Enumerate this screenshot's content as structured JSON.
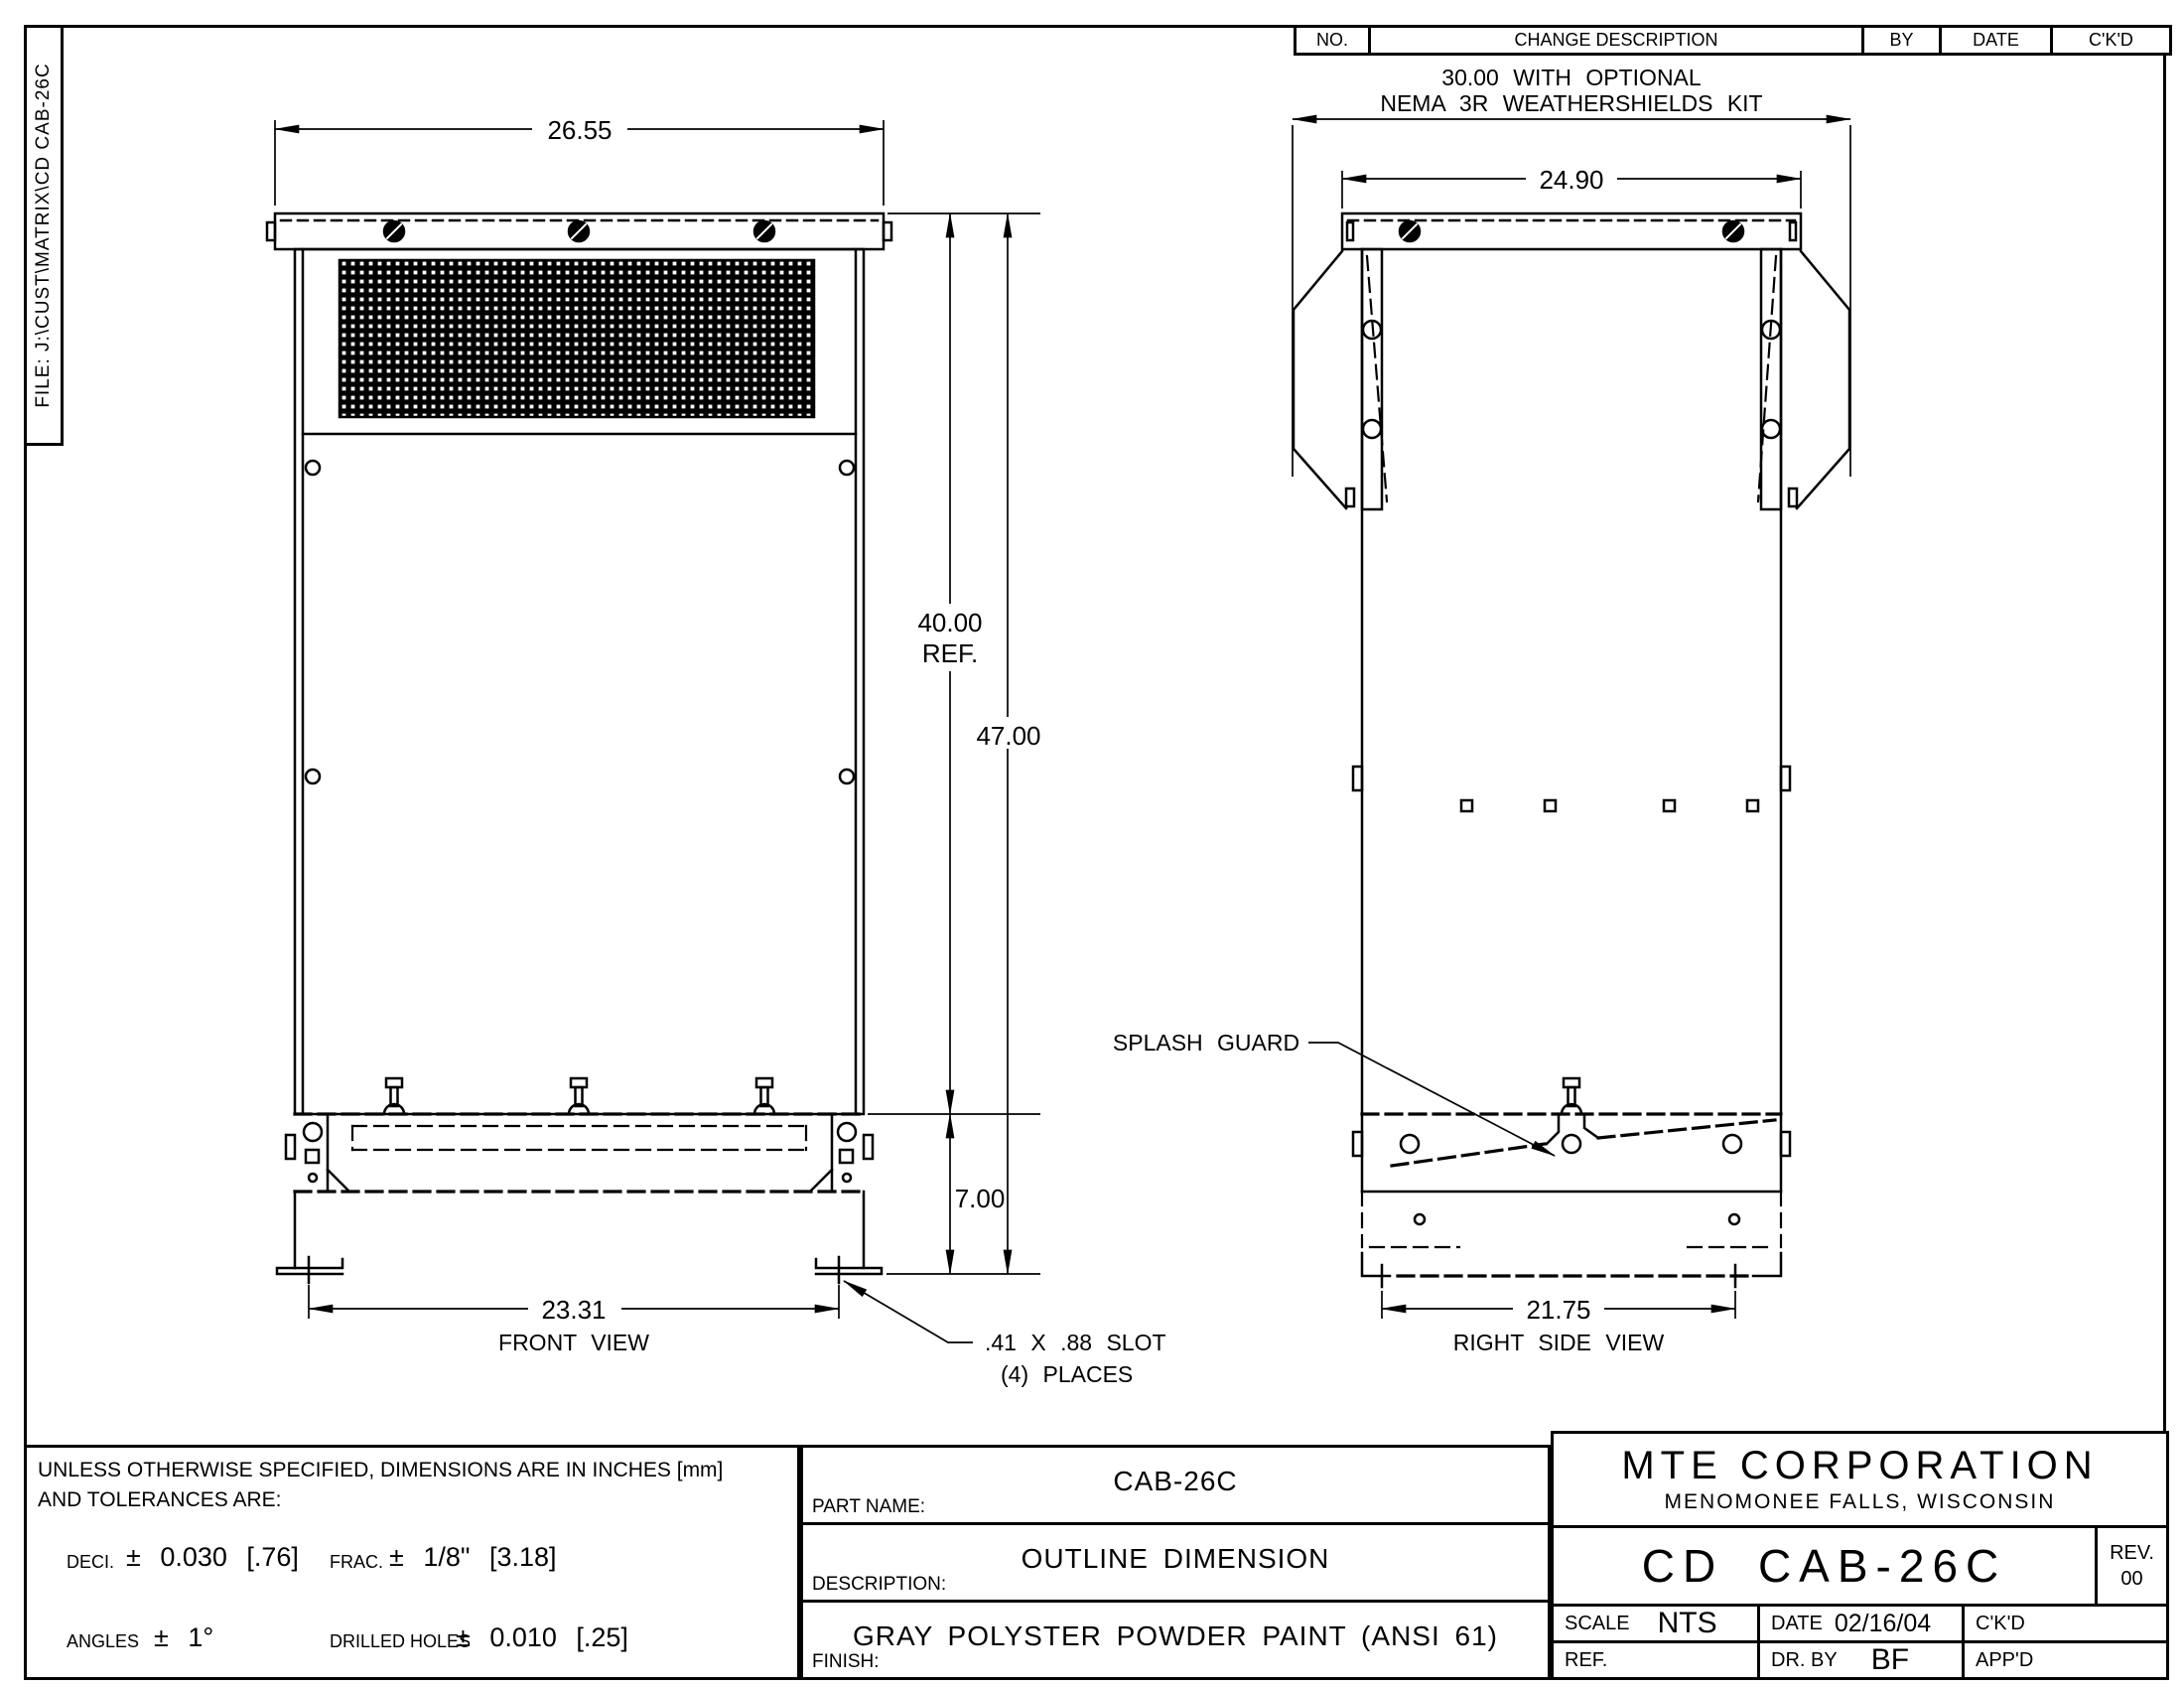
{
  "file_label": "FILE: J:\\CUST\\MATRIX\\CD CAB-26C",
  "revision_table": {
    "headers": [
      "NO.",
      "CHANGE DESCRIPTION",
      "BY",
      "DATE",
      "C'K'D"
    ]
  },
  "front_view": {
    "label": "FRONT VIEW",
    "dim_top_width": "26.55",
    "dim_height_ref_line1": "40.00",
    "dim_height_ref_line2": "REF.",
    "dim_height_overall": "47.00",
    "dim_base_height": "7.00",
    "dim_base_width": "23.31",
    "slot_note_line1": ".41 X .88 SLOT",
    "slot_note_line2": "(4) PLACES"
  },
  "side_view": {
    "label": "RIGHT SIDE VIEW",
    "weathershield_note_line1": "30.00 WITH OPTIONAL",
    "weathershield_note_line2": "NEMA 3R WEATHERSHIELDS KIT",
    "dim_top_width": "24.90",
    "dim_base_width": "21.75",
    "splash_guard_label": "SPLASH GUARD"
  },
  "tolerance_block": {
    "line1": "UNLESS OTHERWISE SPECIFIED, DIMENSIONS ARE IN INCHES [mm]",
    "line2": "AND TOLERANCES ARE:",
    "deci_label": "DECI.",
    "deci_value": "± 0.030 [.76]",
    "frac_label": "FRAC.",
    "frac_value": "± 1/8\" [3.18]",
    "angles_label": "ANGLES",
    "angles_value": "± 1°",
    "drilled_label": "DRILLED HOLES",
    "drilled_value": "± 0.010 [.25]"
  },
  "part_block": {
    "part_name_label": "PART NAME:",
    "part_name_value": "CAB-26C",
    "description_label": "DESCRIPTION:",
    "description_value": "OUTLINE DIMENSION",
    "finish_label": "FINISH:",
    "finish_value": "GRAY POLYSTER POWDER PAINT (ANSI 61)"
  },
  "title_block": {
    "company_name": "MTE CORPORATION",
    "company_city": "MENOMONEE FALLS, WISCONSIN",
    "drawing_number": "CD CAB-26C",
    "rev_label": "REV.",
    "rev_value": "00",
    "scale_label": "SCALE",
    "scale_value": "NTS",
    "date_label": "DATE",
    "date_value": "02/16/04",
    "ckd_label": "C'K'D",
    "ref_label": "REF.",
    "drby_label": "DR. BY",
    "drby_value": "BF",
    "appd_label": "APP'D"
  }
}
